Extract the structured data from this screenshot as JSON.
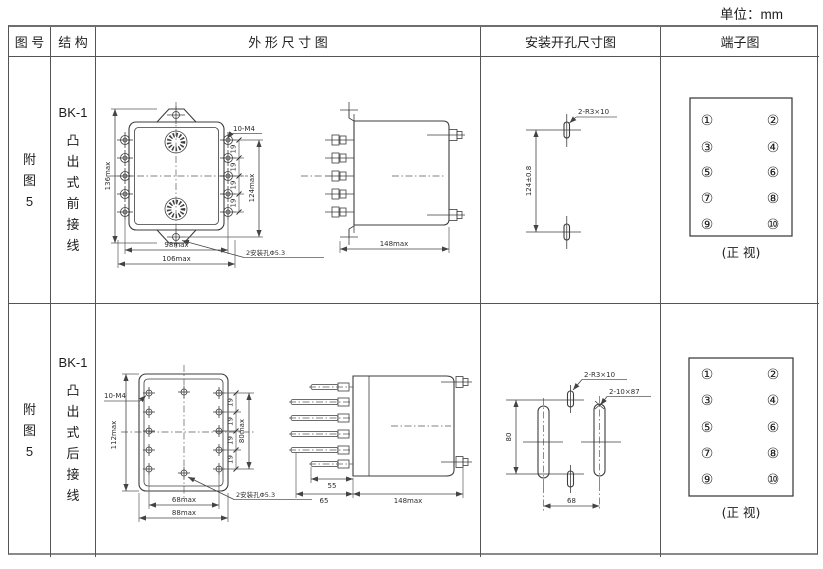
{
  "page": {
    "unit_label": "单位：mm"
  },
  "headers": {
    "fig": "图 号",
    "structure": "结 构",
    "outline": "外 形 尺 寸 图",
    "mounting": "安装开孔尺寸图",
    "terminal": "端子图"
  },
  "rows": [
    {
      "fig_chars": [
        "附",
        "图",
        "5"
      ],
      "structure_model": "BK-1",
      "structure_chars": [
        "凸",
        "出",
        "式",
        "前",
        "接",
        "线"
      ],
      "outline_front": {
        "overall_height": "136max",
        "mount_height": "124max",
        "pitch": [
          "19",
          "19",
          "19",
          "19"
        ],
        "screws": "10-M4",
        "width_inner": "98max",
        "width_outer": "106max",
        "mount_holes": "2安装孔Φ5.3"
      },
      "outline_side": {
        "depth": "148max"
      },
      "mounting": {
        "slots": "2-R3×10",
        "hole_spacing": "124±0.8"
      },
      "terminal": {
        "left": [
          "①",
          "③",
          "⑤",
          "⑦",
          "⑨"
        ],
        "right": [
          "②",
          "④",
          "⑥",
          "⑧",
          "⑩"
        ],
        "caption": "(正 视)"
      }
    },
    {
      "fig_chars": [
        "附",
        "图",
        "5"
      ],
      "structure_model": "BK-1",
      "structure_chars": [
        "凸",
        "出",
        "式",
        "后",
        "接",
        "线"
      ],
      "outline_front": {
        "overall_height": "112max",
        "mount_height": "80max",
        "pitch": [
          "19",
          "19",
          "19",
          "19"
        ],
        "screws": "10-M4",
        "width_inner": "68max",
        "width_outer": "88max",
        "mount_holes": "2安装孔Φ5.3"
      },
      "outline_side": {
        "pin_length": "55",
        "base_depth": "65",
        "depth": "148max"
      },
      "mounting": {
        "slots": "2-R3×10",
        "big_slots": "2-10×87",
        "hole_spacing_v": "80",
        "hole_spacing_h": "68"
      },
      "terminal": {
        "left": [
          "①",
          "③",
          "⑤",
          "⑦",
          "⑨"
        ],
        "right": [
          "②",
          "④",
          "⑥",
          "⑧",
          "⑩"
        ],
        "caption": "(正 视)"
      }
    }
  ]
}
